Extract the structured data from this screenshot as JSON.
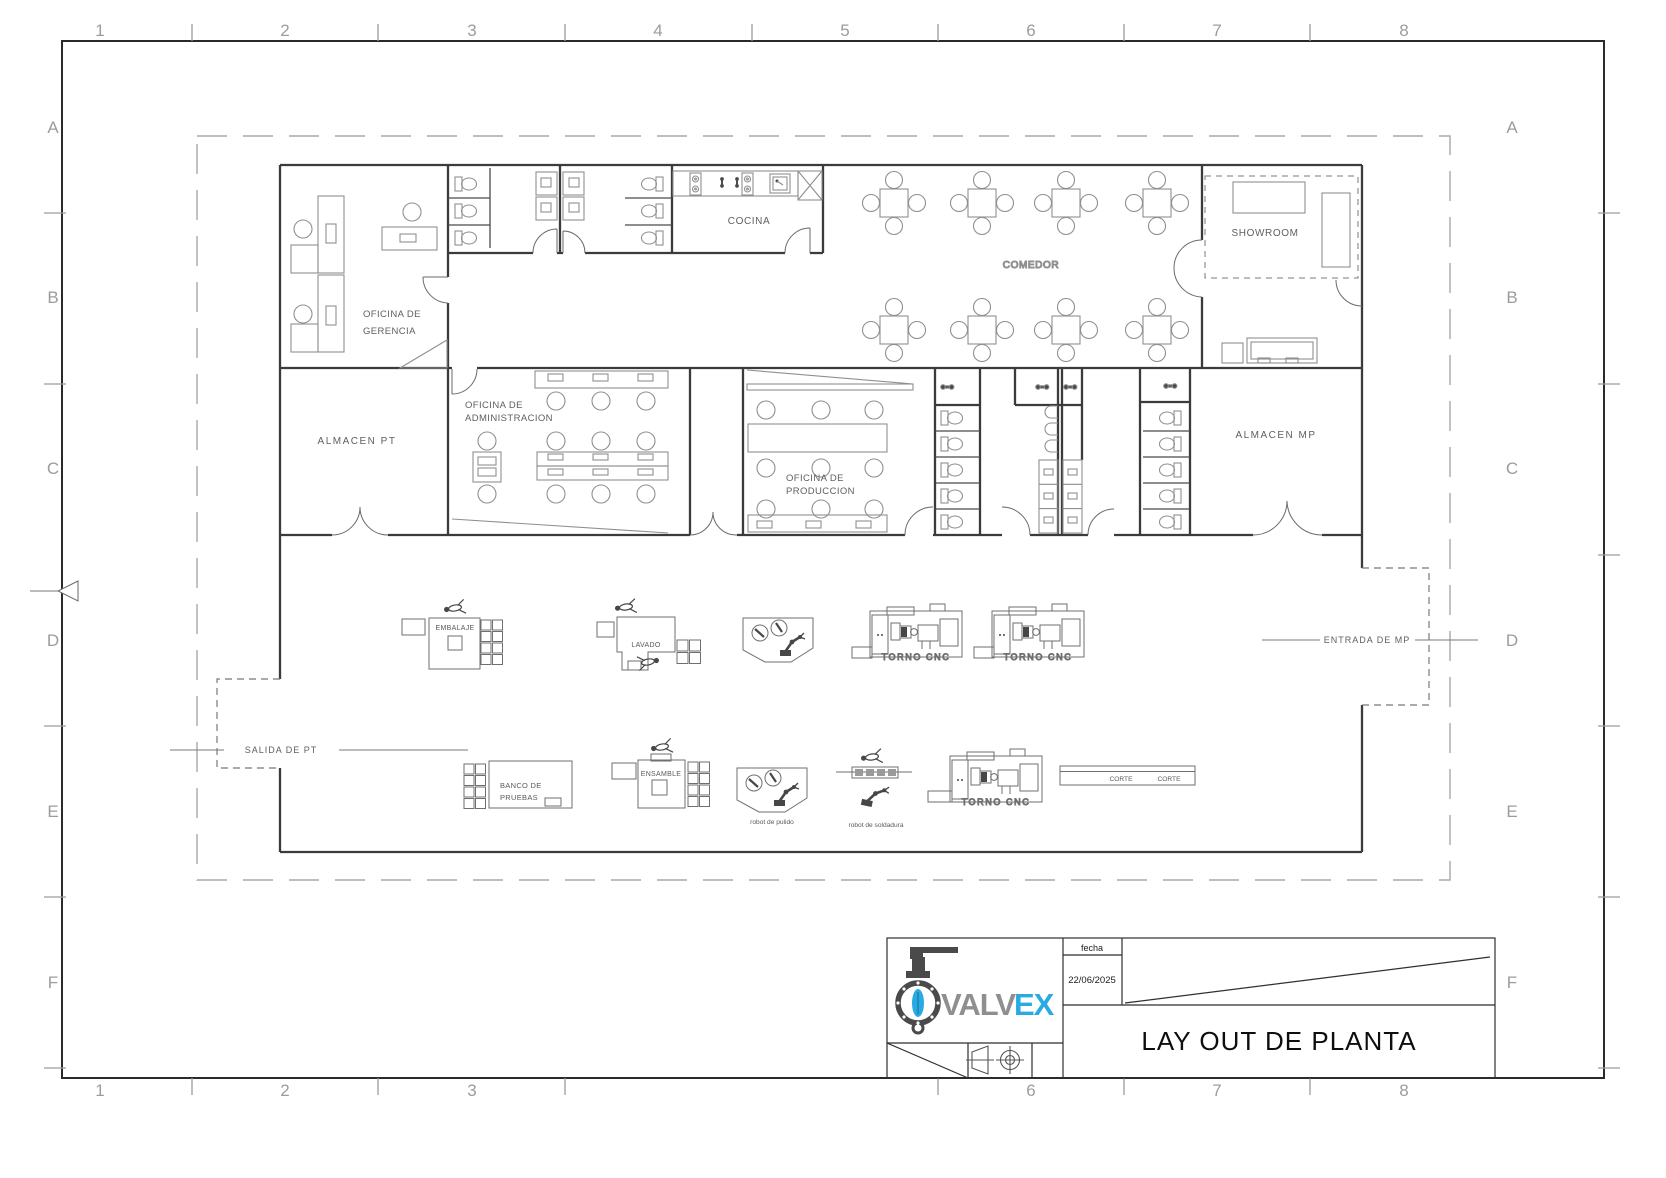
{
  "sheet": {
    "title": "LAY OUT DE PLANTA",
    "date_label": "fecha",
    "date_value": "22/06/2025",
    "logo": {
      "part1": "VALV",
      "part2": "EX"
    },
    "grid": {
      "cols": [
        "1",
        "2",
        "3",
        "4",
        "5",
        "6",
        "7",
        "8"
      ],
      "rows": [
        "A",
        "B",
        "C",
        "D",
        "E",
        "F"
      ]
    }
  },
  "rooms": {
    "gerencia_l1": "OFICINA DE",
    "gerencia_l2": "GERENCIA",
    "cocina": "COCINA",
    "comedor": "COMEDOR",
    "showroom": "SHOWROOM",
    "almacen_pt": "ALMACEN PT",
    "admin_l1": "OFICINA DE",
    "admin_l2": "ADMINISTRACION",
    "produccion_l1": "OFICINA DE",
    "produccion_l2": "PRODUCCION",
    "almacen_mp": "ALMACEN MP"
  },
  "stations": {
    "embalaje": "EMBALAJE",
    "lavado": "LAVADO",
    "torno_cnc": "TORNO CNC",
    "ensamble": "ENSAMBLE",
    "banco_l1": "BANCO DE",
    "banco_l2": "PRUEBAS",
    "corte": "CORTE",
    "robot_pulido": "robot de pulido",
    "robot_soldadura": "robot de soldadura"
  },
  "flows": {
    "entrada_mp": "ENTRADA DE MP",
    "salida_pt": "SALIDA DE PT"
  },
  "colors": {
    "logo_blue": "#29abe2",
    "logo_gray": "#8f8f8f",
    "line_dark": "#3b3b3b"
  }
}
